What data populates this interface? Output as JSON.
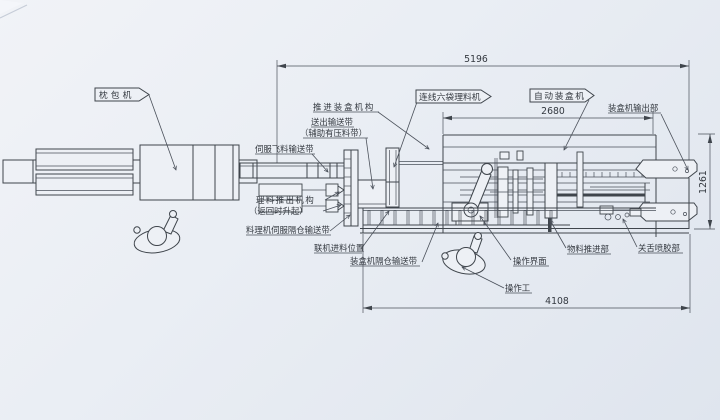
{
  "drawing": {
    "labels": {
      "pillow_packer": "枕包机",
      "collator": "连线六袋理料机",
      "cartoner": "自动装盒机",
      "push_mechanism": "推进装盒机构",
      "outfeed_belt": "送出输送带",
      "outfeed_belt_note": "（辅助有压料带）",
      "servo_fly_belt": "伺服飞料输送带",
      "pushout_mech": "理料推出机构",
      "pushout_mech_note": "（返回时升起）",
      "collator_servo_belt": "料理机伺服隔仓输送带",
      "inline_feed_pos": "联机进料位置",
      "cartoner_compartment_belt": "装盒机隔仓输送带",
      "hmi": "操作界面",
      "operator": "操作工",
      "material_push": "物料推进部",
      "glue_section": "关舌喷胶部",
      "cartoner_outlet": "装盒机输出部"
    },
    "dimensions": {
      "overall": "5196",
      "cartoner": "2680",
      "floor": "4108",
      "depth": "1261"
    },
    "style": {
      "line_color": "#3f454c",
      "paper_color": "#edf0f5"
    }
  }
}
